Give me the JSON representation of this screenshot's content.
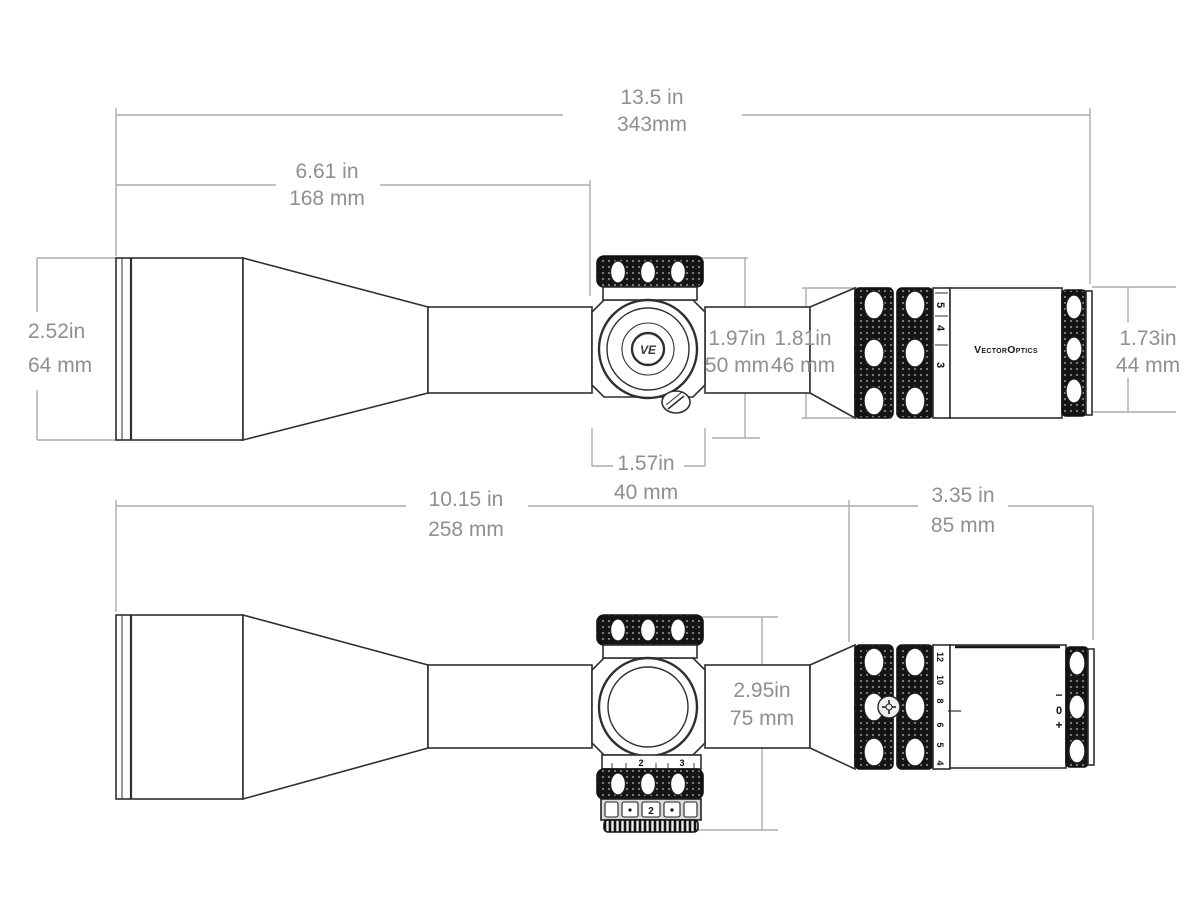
{
  "diagram": {
    "title": "riflescope-dimension-drawing",
    "colors": {
      "line": "#2f2f2f",
      "knurl": "#141414",
      "dim_line": "#acacac",
      "dim_text": "#8f8f8f",
      "background": "#ffffff"
    },
    "views": {
      "side": {
        "dims": {
          "overall": {
            "in": "13.5 in",
            "mm": "343mm"
          },
          "front": {
            "in": "6.61 in",
            "mm": "168 mm"
          },
          "objective": {
            "in": "2.52in",
            "mm": "64 mm"
          },
          "turret": {
            "in": "1.97in",
            "mm": "50 mm"
          },
          "housing": {
            "in": "1.81in",
            "mm": "46 mm"
          },
          "ocular": {
            "in": "1.73in",
            "mm": "44 mm"
          },
          "turret_cap": {
            "in": "1.57in",
            "mm": "40 mm"
          }
        },
        "labels": {
          "brand": "VectorOptics",
          "logo": "VE",
          "mag_numbers": [
            "5",
            "4",
            "3"
          ]
        }
      },
      "top": {
        "dims": {
          "rear": {
            "in": "10.15 in",
            "mm": "258 mm"
          },
          "ocular_assembly": {
            "in": "3.35 in",
            "mm": "85 mm"
          },
          "saddle_height": {
            "in": "2.95in",
            "mm": "75 mm"
          }
        },
        "labels": {
          "mag_numbers": [
            "12",
            "10",
            "8",
            "6",
            "5",
            "4"
          ],
          "diopter_marks": [
            "−",
            "0",
            "+"
          ],
          "turret_scale": [
            "2",
            "3"
          ],
          "turret_click": "2"
        }
      }
    }
  }
}
